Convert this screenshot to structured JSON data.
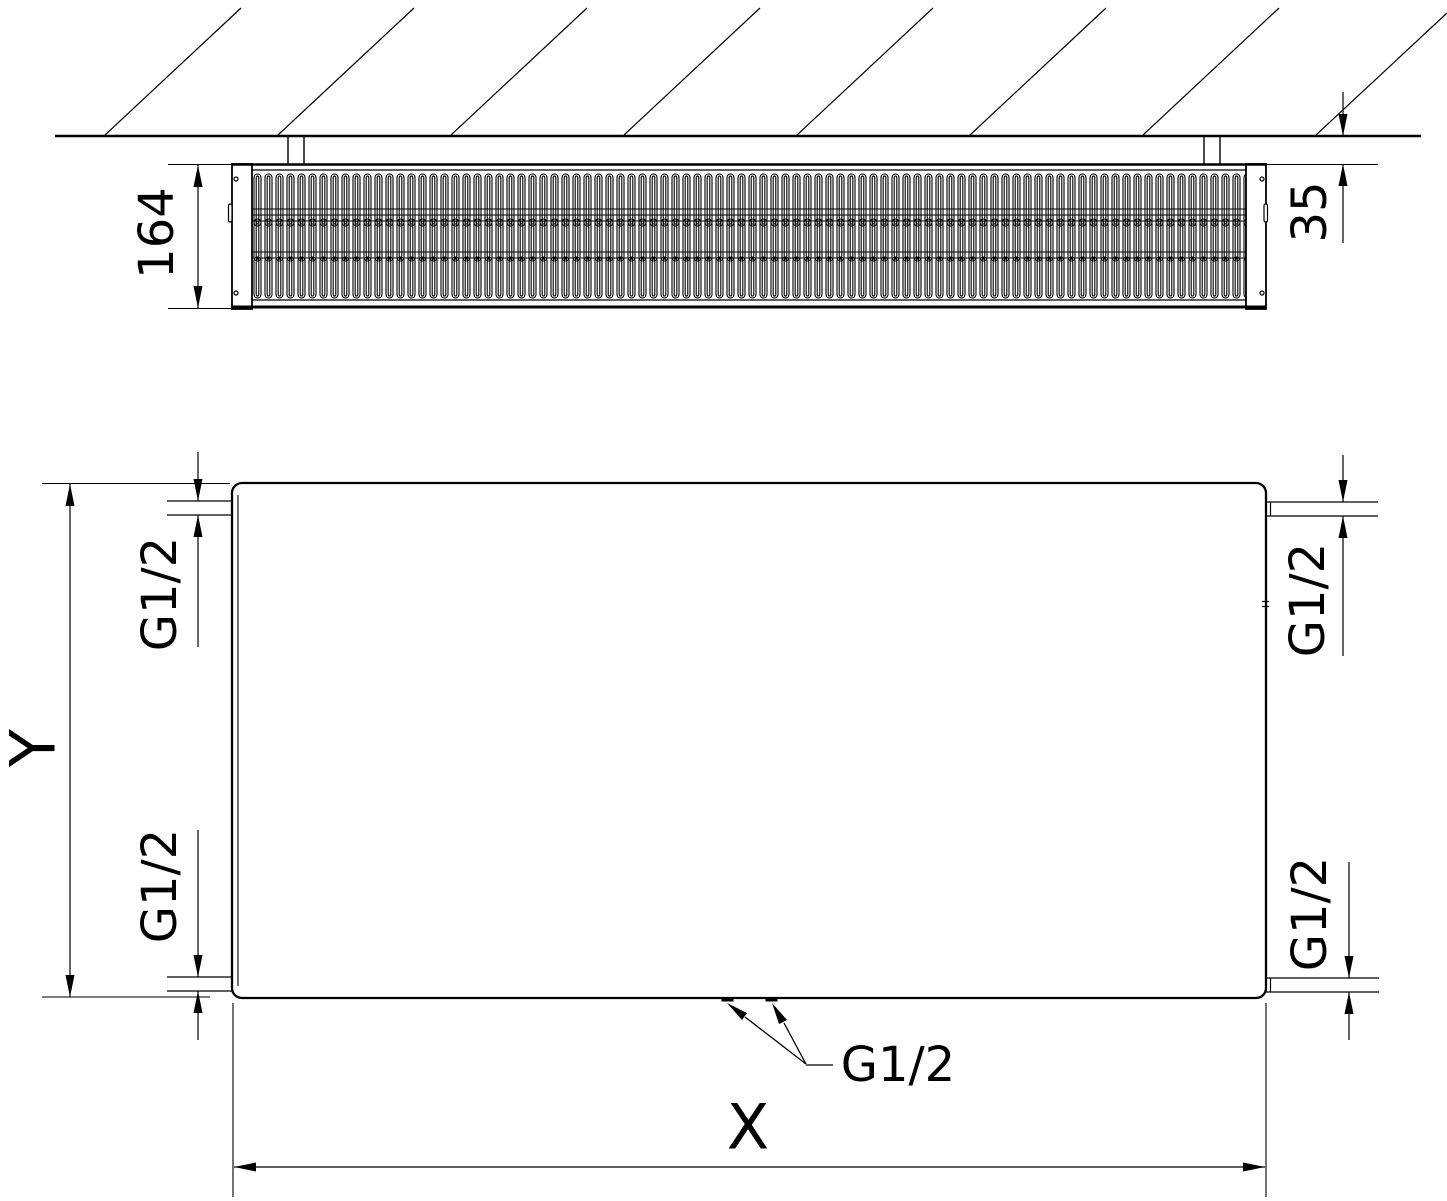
{
  "top_view": {
    "depth_dimension": "164",
    "wall_clearance_dimension": "35"
  },
  "front_view": {
    "height_dimension": "Y",
    "width_dimension": "X",
    "connections": {
      "top_left": "G1/2",
      "top_right": "G1/2",
      "bottom_left": "G1/2",
      "bottom_right": "G1/2",
      "bottom_center": "G1/2"
    }
  },
  "colors": {
    "line_color": "#000000",
    "background": "#ffffff"
  }
}
